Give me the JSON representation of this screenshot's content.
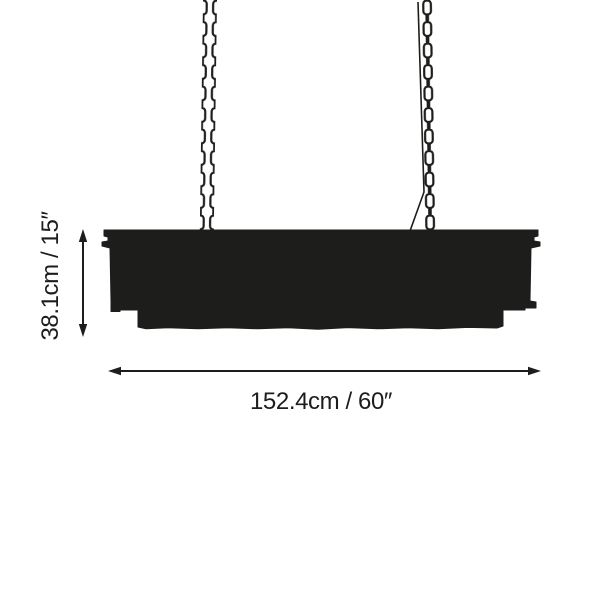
{
  "page": {
    "background_color": "#ffffff",
    "ink_color": "#1d1d1b"
  },
  "diagram": {
    "type": "product-dimension-diagram",
    "subject": "linear-chandelier-silhouette-with-two-suspension-chains",
    "dimensions": {
      "height": {
        "cm": "38.1",
        "inches": "15",
        "label": "38.1cm / 15″"
      },
      "width": {
        "cm": "152.4",
        "inches": "60",
        "label": "152.4cm / 60″"
      }
    }
  }
}
